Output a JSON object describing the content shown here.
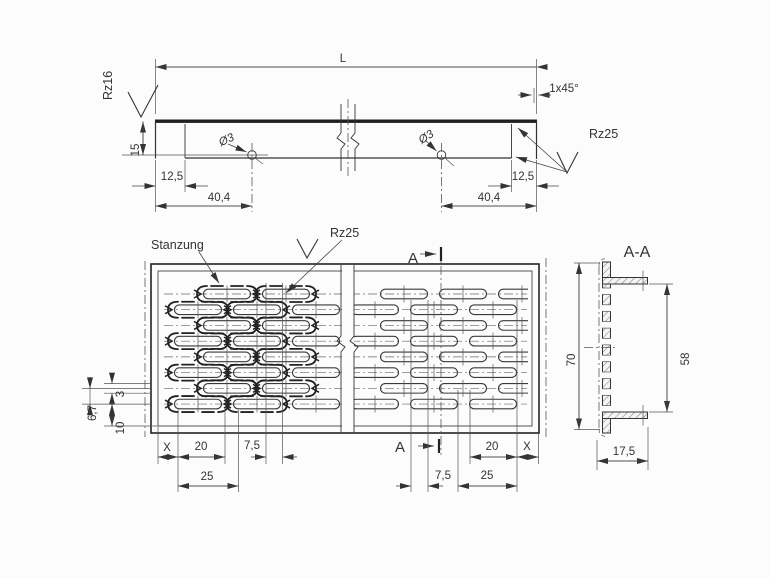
{
  "top_view": {
    "length_label": "L",
    "rz16": "Rz16",
    "rz25": "Rz25",
    "chamfer": "1x45°",
    "hole_left": "Ø3",
    "hole_right": "Ø3",
    "dim_15": "15",
    "dim_125_left": "12,5",
    "dim_404_left": "40,4",
    "dim_125_right": "12,5",
    "dim_404_right": "40,4"
  },
  "plan_view": {
    "stanzung": "Stanzung",
    "rz25": "Rz25",
    "section_letter_top": "A",
    "section_letter_bottom": "A",
    "dim_x_left": "X",
    "dim_20_left": "20",
    "dim_75_left": "7,5",
    "dim_25_left": "25",
    "dim_75_right": "7,5",
    "dim_25_right": "25",
    "dim_20_right": "20",
    "dim_x_right": "X",
    "dim_3": "3",
    "dim_67": "6,7",
    "dim_10": "10"
  },
  "section_view": {
    "title": "A-A",
    "dim_70": "70",
    "dim_58": "58",
    "dim_175": "17,5"
  },
  "plan_pattern": {
    "rows": 8,
    "y0": 294,
    "pitch": 15.72,
    "even_centers": [
      227,
      286,
      345,
      404,
      463,
      522
    ],
    "odd_centers": [
      198,
      257,
      316,
      375,
      434,
      493
    ],
    "slot_w": 47,
    "slot_h": 9.6,
    "break_center": 348,
    "punch_right_limit": 338,
    "line_x1": 164,
    "line_x2": 527
  },
  "colors": {
    "line": "#333333",
    "background": "#fcfcfc"
  }
}
